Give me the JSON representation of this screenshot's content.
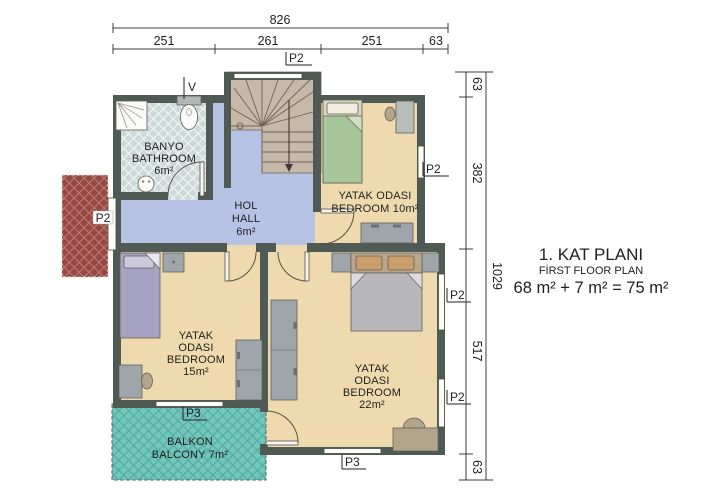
{
  "title": {
    "kat_plani": "1. KAT PLANI",
    "first_floor_plan": "FİRST FLOOR PLAN",
    "area_equation": "68 m² + 7 m² = 75 m²"
  },
  "dims": {
    "top": {
      "total": "826",
      "segs": [
        "251",
        "261",
        "251",
        "63"
      ]
    },
    "right": {
      "total": "1029",
      "segs": [
        "63",
        "382",
        "517",
        "63"
      ]
    }
  },
  "openings": {
    "p2": "P2",
    "p3": "P3",
    "vent": "V"
  },
  "rooms": {
    "bathroom": {
      "name_tr": "BANYO",
      "name_en": "BATHROOM",
      "area": "6m²"
    },
    "hall": {
      "name_tr": "HOL",
      "name_en": "HALL",
      "area": "6m²"
    },
    "bedroom10": {
      "name_tr": "YATAK ODASI",
      "name_en": "BEDROOM 10m²"
    },
    "bedroom15": {
      "name_tr": "YATAK",
      "name_tr2": "ODASI",
      "name_en": "BEDROOM",
      "area": "15m²"
    },
    "bedroom22": {
      "name_tr": "YATAK",
      "name_tr2": "ODASI",
      "name_en": "BEDROOM",
      "area": "22m²"
    },
    "balcony": {
      "name_tr": "BALKON",
      "name_en": "BALCONY 7m²"
    }
  },
  "colors": {
    "wall": "#4f5a54",
    "bedroomFloor": "#eedaae",
    "hallFloor": "#b7c3e4",
    "stairFloor": "#c7b9a8",
    "bathroomFloor": "#ccd9d9",
    "balcony": "#6fc8bc",
    "terrace": "#964845",
    "window": "#fcfcf8",
    "line": "#3c3c3c"
  }
}
